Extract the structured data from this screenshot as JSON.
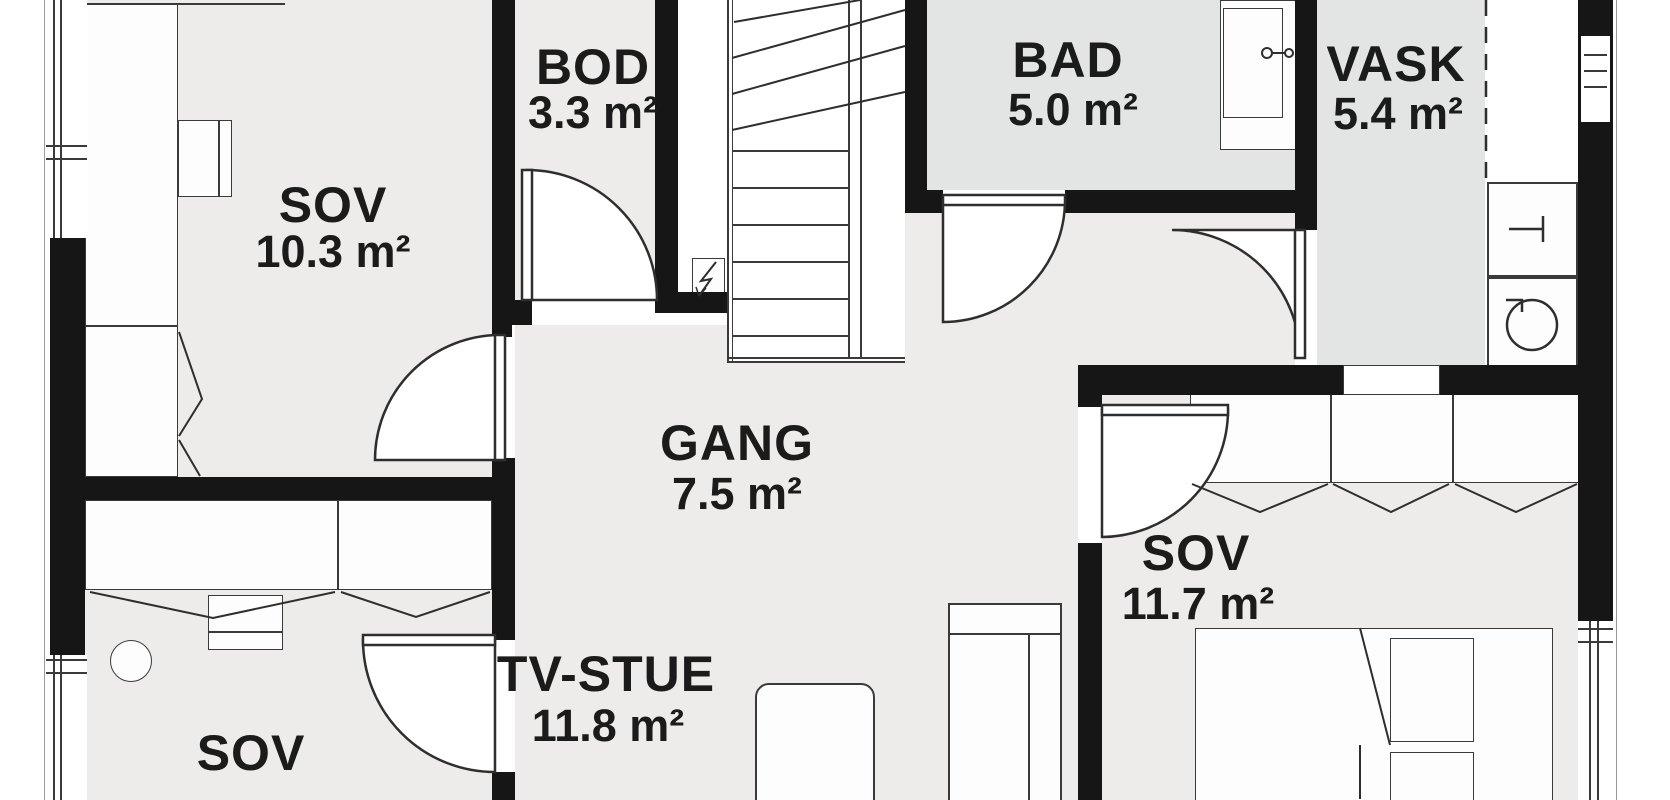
{
  "colors": {
    "wall": "#161616",
    "line": "#3a3a3a",
    "floor": "#edecea",
    "floor_wet": "#e3e4e4",
    "outside": "#ffffff"
  },
  "rooms": {
    "sov1": {
      "name": "SOV",
      "area": "10.3 m²"
    },
    "bod": {
      "name": "BOD",
      "area": "3.3 m²"
    },
    "bad": {
      "name": "BAD",
      "area": "5.0 m²"
    },
    "vask": {
      "name": "VASK",
      "area": "5.4 m²"
    },
    "gang": {
      "name": "GANG",
      "area": "7.5 m²"
    },
    "sov2": {
      "name": "SOV",
      "area": "11.7 m²"
    },
    "tvstue": {
      "name": "TV-STUE",
      "area": "11.8 m²"
    },
    "sov3": {
      "name": "SOV"
    }
  },
  "icons": {
    "washing_machine": "washing-machine-icon",
    "dryer": "dryer-icon",
    "shower_mixer": "shower-mixer-icon",
    "electrical_panel": "electrical-panel-icon",
    "stairs": "staircase"
  }
}
